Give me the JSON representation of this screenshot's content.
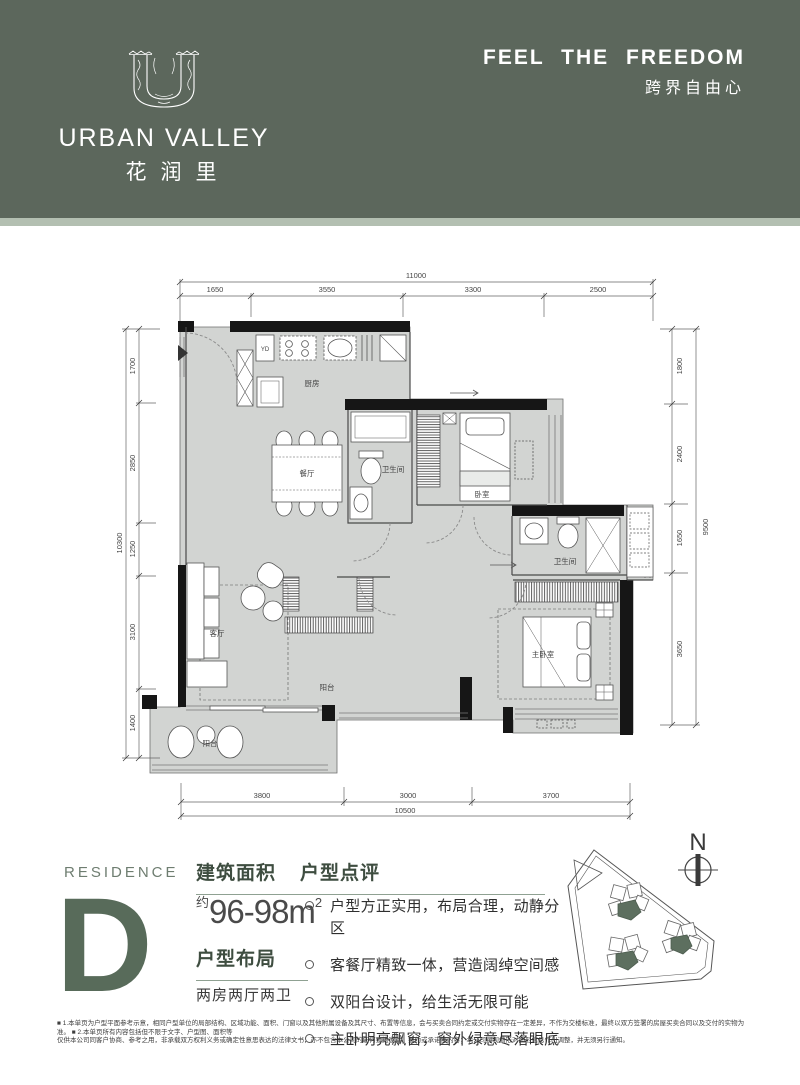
{
  "header": {
    "brand_en": "URBAN VALLEY",
    "brand_cn": "花润里",
    "slogan_en": "FEEL THE FREEDOM",
    "slogan_cn": "跨界自由心"
  },
  "plan": {
    "dims": {
      "top_total": "11000",
      "top_segments": [
        "1650",
        "3550",
        "3300",
        "2500"
      ],
      "left_total": "10300",
      "left_segments": [
        "1700",
        "2850",
        "1250",
        "3100",
        "1400"
      ],
      "right_total": "9500",
      "right_segments": [
        "1800",
        "2400",
        "1650",
        "3650"
      ],
      "bottom_total": "10500",
      "bottom_segments": [
        "3800",
        "3000",
        "3700"
      ]
    },
    "rooms": {
      "kitchen": "厨房",
      "dining": "餐厅",
      "bath1": "卫生间",
      "bedroom": "卧室",
      "living": "客厅",
      "bath2": "卫生间",
      "master": "主卧室",
      "balcony_center": "阳台",
      "balcony_front": "阳台",
      "yd_box": "YD"
    }
  },
  "residence": {
    "label": "RESIDENCE",
    "letter": "D"
  },
  "info": {
    "area_heading": "建筑面积",
    "area_prefix": "约",
    "area_value": "96-98m",
    "area_sup": "2",
    "layout_heading": "户型布局",
    "layout_value": "两房两厅两卫",
    "review_heading": "户型点评",
    "bullets": [
      "户型方正实用，布局合理，动静分区",
      "客餐厅精致一体，营造阔绰空间感",
      "双阳台设计，给生活无限可能",
      "主卧明亮飘窗，窗外绿意尽落眼底"
    ]
  },
  "site": {
    "north_label": "N"
  },
  "disclaimer": {
    "line1": "■ 1.本单页为户型平面参考示意，相同户型单位的局部结构、区域功能、面积、门窗以及其他附属设备及其尺寸、布置等信息，会与买卖合同约定或交付实物存在一定差异，不作为交楼标准，最终以双方签署的房屋买卖合同以及交付的实物为准。  ■ 2.本单页所有内容包括但不限于文字、户型图、面积等",
    "line2": "仅供本公司同客户协商、参考之用，非承载双方权利义务或确定性意思表达的法律文书，亦不包含本公司的任何要约邀请、要约或承诺性内容；本公司可视情形对图形信息作出调整，并无须另行通知。"
  },
  "colors": {
    "header_green": "#5c675c",
    "header_strip": "#b3bfb1",
    "accent_green": "#586b5a",
    "floor_gray": "#d2d4d2"
  }
}
